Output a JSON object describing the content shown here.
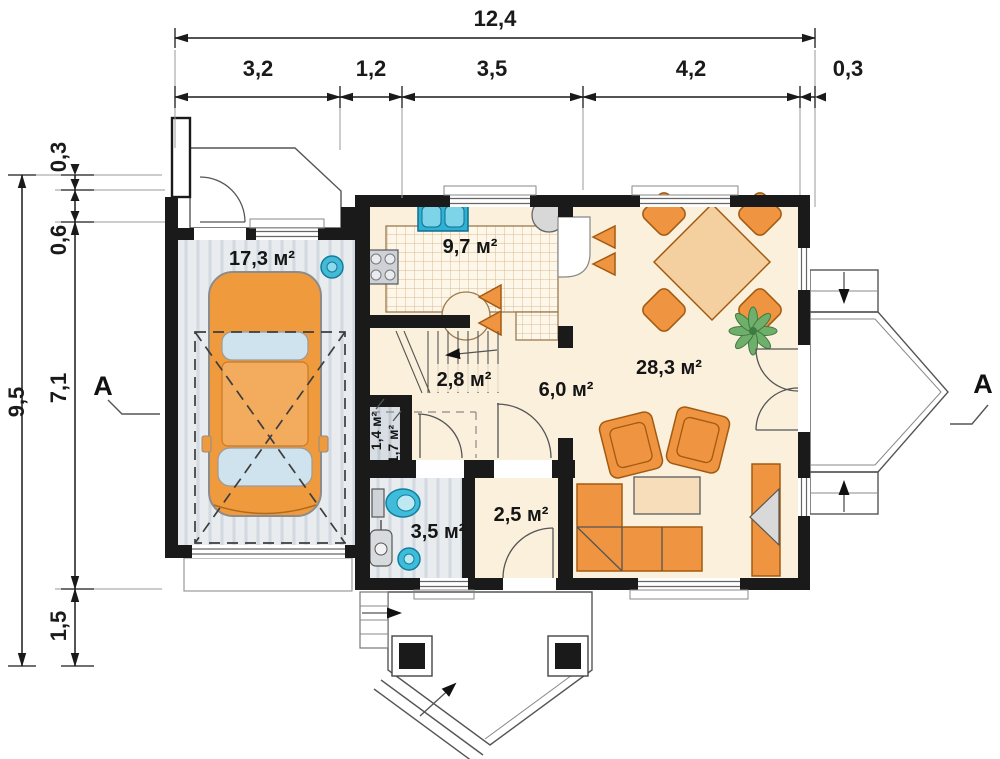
{
  "dimensions": {
    "top": {
      "total": "12,4",
      "segments": [
        "3,2",
        "1,2",
        "3,5",
        "4,2",
        "0,3"
      ]
    },
    "left": {
      "total": "9,5",
      "segments": [
        "0,3",
        "0,6",
        "7,1",
        "1,5"
      ]
    }
  },
  "rooms": {
    "garage": "17,3 м²",
    "kitchen": "9,7 м²",
    "stairs": "2,8 м²",
    "closet_left": "1,4 м²",
    "closet_right": "1,7 м²",
    "bathroom": "3,5 м²",
    "entry": "2,5 м²",
    "hall": "6,0 м²",
    "living": "28,3 м²"
  },
  "section": {
    "left": "A",
    "right": "A"
  },
  "colors": {
    "wall": "#1a1a1a",
    "floor_cream": "#faf0dc",
    "floor_light": "#fdf8ee",
    "floor_gray": "#e8ecef",
    "stripe_gray": "#d2d9e0",
    "closet_gray": "#d9dee4",
    "closet_stripe": "#c3cad2",
    "orange": "#ef9440",
    "orange_dark": "#a35a10",
    "orange_light": "#f4d0a0",
    "water_blue": "#3fbcd9",
    "water_dark": "#117d9e",
    "plant_green": "#6fae6b",
    "counter_grid": "#dcb88d",
    "car_orange": "#f09a3e",
    "glass_blue": "#cfe3ee",
    "dim": "#1a1a1a"
  }
}
